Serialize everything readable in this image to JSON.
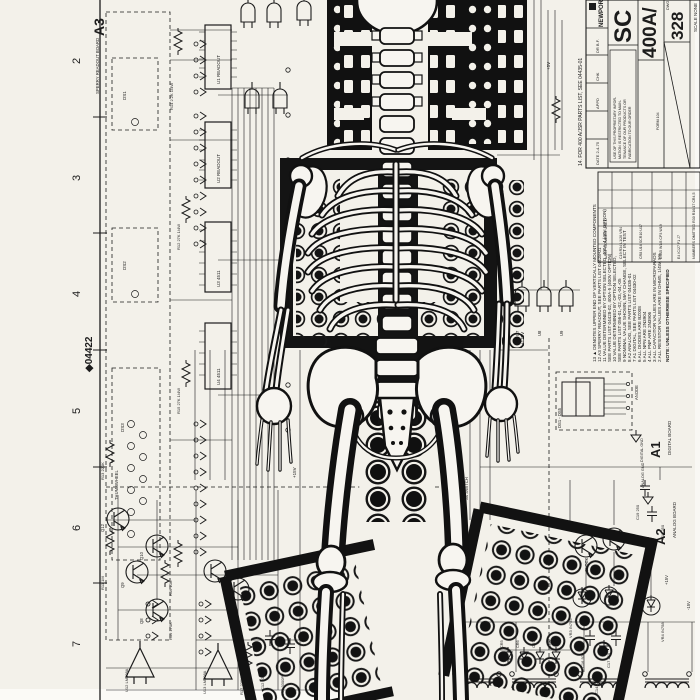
{
  "sheet": {
    "doc_no": "◆04422",
    "zones": [
      "2",
      "3",
      "4",
      "5",
      "6",
      "7"
    ]
  },
  "title_block": {
    "brand": "NEWPORT",
    "title": "SC",
    "model": "400A/",
    "dwg_no": "328",
    "dwg_label": "DWG",
    "scale": "SCALE NONE",
    "form": "FORM 104",
    "parts_note": "14. FOR 400 A/JSR PARTS LIST, SEE 04435-01",
    "proprietary": [
      "USE OF THIS PROPRIETARY INFOR-",
      "MATION IS RESTRICTED TO MAIN-",
      "TENANCE OF OUR PRODUCTS OR",
      "FABRICATION TO OUR ORDER"
    ],
    "approvals": [
      "DR B.F.",
      "CHK",
      "APPD",
      "DATE 2-4-75"
    ],
    "last_used": {
      "heading": "LAST NUMBER USED",
      "rows": [
        "C19 R34 L1/20 VR4",
        "CR8 U16 SCR10 U17",
        "DS15 W1/8 CP3 W19",
        "E4 IC/27 F1 J7"
      ],
      "omitted": "NUMBERS OMITTED R30 R16/17 CR4,5"
    }
  },
  "notes": {
    "heading": "NOTE: UNLESS OTHERWISE SPECIFIED",
    "items": [
      "13 ▲ DENOTES UPPER END OF VERTICALLY MOUNTED COMPONENTS",
      "12 A3 SPERRY READOUT, SEE PARTS LIST 04428-01",
      "11 VALUE DETERMINED BY OPTION SELECTED, 400A-4 (40V OPTION)",
      "   SEE PARTS LIST 04428-02, 400A-5 (400V OPTION)",
      "10 VALUE DETERMINED BY OPTION SELECTED,",
      "   SEE PARTS LIST 056-01,-02,-03,-04,-05",
      "9  NOMINAL VALUE SHOWN, MAY CHANGE, SELECT IN TEST",
      "8  A2 ANALOG, SEE PARTS LIST 04435-01",
      "7  A1 DIGITAL, SEE PARTS LIST 04430-02",
      "6  ALL DIODES ARE BZ008",
      "5  ALL NPN ARE 2N3904",
      "4  ALL PNP ARE 2N3906",
      "3  ALL CAPACITOR VALUES ARE IN MICROFARADS",
      "2  ALL RESISTOR VALUES ARE IN OHMS, 1/4W, 5%"
    ]
  },
  "labels": {
    "a3": "A3",
    "a3_name": "SPERRY READOUT BOARD",
    "a1": "A1",
    "a1_name": "DIGITAL BOARD",
    "a2": "A2",
    "a2_name": "ANALOG BOARD",
    "ds_box": "DS1 - DS5",
    "anode": "ANODE",
    "dig_gnd": "DIGITAL GND",
    "ana_gnd": "ANALOG GND",
    "p5": "+5V",
    "p15": "+15V",
    "m15": "-15V",
    "p175": "+175V",
    "u1": "U1 READOUT",
    "u2": "U2 READOUT",
    "u3": "U3 4511",
    "u4": "U4 4511",
    "u7": "U7",
    "u8": "U8",
    "u9": "U9",
    "u12": "U12 LM308A",
    "u13": "U13 LM308A",
    "q8": "Q8",
    "q9": "Q9",
    "q10": "Q10",
    "q12": "Q12",
    "r11": "R11 1M",
    "r12": "R12 27K 1/4W",
    "r13": "R13 220K",
    "r14": "R14 2.2K 1/4W",
    "r15": "R15 27K 1/4W",
    "r16": "R16 10K",
    "r17": "R17 220K",
    "r19": "R19 270K",
    "c12": "C12 1000PF",
    "c13": "C13 3300PF",
    "c14": "C14 .01",
    "c16": "C16 500",
    "c17": "C17 250",
    "c18": "C18 250",
    "c19": "C19 250",
    "cr5": "CR5",
    "cr6": "CR6",
    "cr7": "CR7",
    "cr8": "CR8",
    "vr3": "VR3 IN755",
    "vr4": "VR4 IN758",
    "ds1": "DS1",
    "ds2": "DS2",
    "ds3": "DS3",
    "s4": "S4 SWITCH",
    "clock": "CLOCK",
    "thumbwheel": "THUMBWHEEL"
  }
}
